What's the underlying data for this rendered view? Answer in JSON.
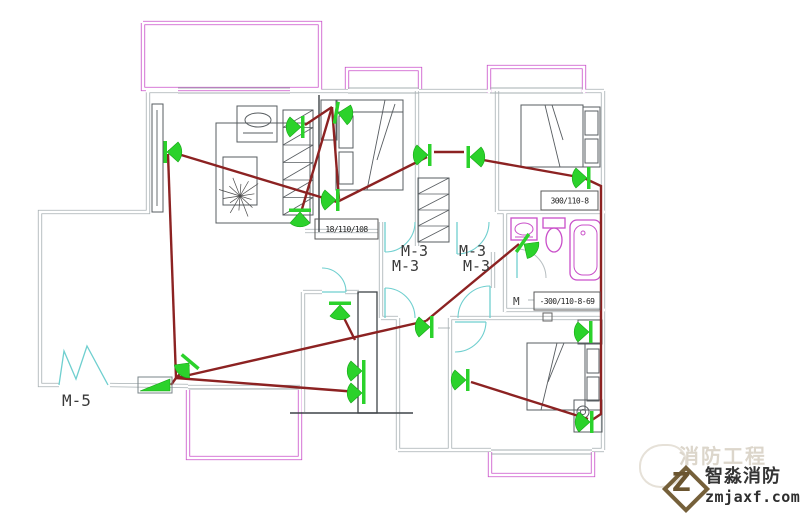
{
  "watermark": {
    "brand": "智淼消防",
    "site": "zmjaxf.com",
    "ghost": "消防工程",
    "logo_letter": "Z"
  },
  "drawing": {
    "canvas": {
      "w": 809,
      "h": 521
    },
    "colors": {
      "wall": "#a6afb2",
      "black": "#3f4448",
      "furn": "#575c60",
      "mag": "#c94fc9",
      "cyan": "#6fcfcf",
      "red": "#8c2222",
      "green": "#2bd22b",
      "greenEdge": "#17a817",
      "text": "#3a3a3a",
      "boxText": "#222222",
      "white": "#ffffff",
      "grayArc": "#b7bec1"
    },
    "walls_double": [
      [
        [
          148,
          92
        ],
        [
          148,
          212
        ],
        [
          40,
          212
        ],
        [
          40,
          385
        ],
        [
          59,
          385
        ]
      ],
      [
        [
          110,
          385
        ],
        [
          188,
          386
        ]
      ],
      [
        [
          146,
          91
        ],
        [
          178,
          91
        ]
      ],
      [
        [
          290,
          91
        ],
        [
          348,
          91
        ]
      ],
      [
        [
          419,
          91
        ],
        [
          491,
          91
        ]
      ],
      [
        [
          582,
          91
        ],
        [
          604,
          91
        ]
      ],
      [
        [
          603,
          91
        ],
        [
          603,
          450
        ]
      ],
      [
        [
          497,
          91
        ],
        [
          497,
          212
        ]
      ],
      [
        [
          417,
          91
        ],
        [
          417,
          246
        ]
      ],
      [
        [
          497,
          212
        ],
        [
          605,
          212
        ]
      ],
      [
        [
          505,
          212
        ],
        [
          505,
          312
        ]
      ],
      [
        [
          505,
          310
        ],
        [
          605,
          310
        ]
      ],
      [
        [
          305,
          231
        ],
        [
          378,
          231
        ]
      ],
      [
        [
          303,
          292
        ],
        [
          303,
          412
        ]
      ],
      [
        [
          303,
          292
        ],
        [
          322,
          292
        ]
      ],
      [
        [
          345,
          292
        ],
        [
          359,
          292
        ]
      ],
      [
        [
          188,
          387
        ],
        [
          300,
          387
        ]
      ],
      [
        [
          381,
          222
        ],
        [
          381,
          318
        ]
      ],
      [
        [
          493,
          252
        ],
        [
          493,
          288
        ]
      ],
      [
        [
          381,
          318
        ],
        [
          398,
          318
        ]
      ],
      [
        [
          398,
          318
        ],
        [
          398,
          450
        ]
      ],
      [
        [
          398,
          450
        ],
        [
          491,
          450
        ]
      ],
      [
        [
          592,
          450
        ],
        [
          604,
          450
        ]
      ],
      [
        [
          450,
          318
        ],
        [
          603,
          318
        ]
      ],
      [
        [
          450,
          318
        ],
        [
          450,
          450
        ]
      ]
    ],
    "walls_single": [
      [
        [
          178,
          88
        ],
        [
          290,
          88
        ]
      ],
      [
        [
          178,
          93
        ],
        [
          290,
          93
        ]
      ],
      [
        [
          348,
          88
        ],
        [
          419,
          88
        ]
      ],
      [
        [
          348,
          93
        ],
        [
          419,
          93
        ]
      ],
      [
        [
          490,
          88
        ],
        [
          583,
          88
        ]
      ],
      [
        [
          490,
          93
        ],
        [
          583,
          93
        ]
      ],
      [
        [
          491,
          450
        ],
        [
          592,
          450
        ]
      ],
      [
        [
          491,
          454
        ],
        [
          592,
          454
        ]
      ],
      [
        [
          189,
          389
        ],
        [
          299,
          389
        ]
      ],
      [
        [
          452,
          380
        ],
        [
          460,
          380
        ]
      ],
      [
        [
          438,
          328
        ],
        [
          450,
          328
        ]
      ],
      [
        [
          528,
          300
        ],
        [
          534,
          300
        ]
      ]
    ],
    "magenta_double": [
      [
        [
          143,
          23
        ],
        [
          320,
          23
        ],
        [
          320,
          89
        ],
        [
          143,
          89
        ],
        [
          143,
          23
        ]
      ],
      [
        [
          347,
          89
        ],
        [
          347,
          69
        ],
        [
          420,
          69
        ],
        [
          420,
          89
        ]
      ],
      [
        [
          489,
          93
        ],
        [
          489,
          67
        ],
        [
          584,
          67
        ],
        [
          584,
          93
        ]
      ],
      [
        [
          490,
          452
        ],
        [
          490,
          475
        ],
        [
          593,
          475
        ],
        [
          593,
          452
        ]
      ],
      [
        [
          188,
          390
        ],
        [
          188,
          458
        ],
        [
          300,
          458
        ],
        [
          300,
          390
        ]
      ]
    ],
    "black_lines": [
      [
        [
          319,
          95
        ],
        [
          319,
          232
        ]
      ],
      [
        [
          290,
          413
        ],
        [
          413,
          413
        ]
      ]
    ],
    "black_rects": [
      [
        358,
        292,
        19,
        121
      ]
    ],
    "furniture_rects": [
      [
        152,
        104,
        11,
        108
      ],
      [
        216,
        123,
        94,
        100
      ],
      [
        223,
        157,
        34,
        48
      ],
      [
        237,
        106,
        40,
        36
      ],
      [
        336,
        100,
        67,
        90
      ],
      [
        339,
        116,
        14,
        32
      ],
      [
        339,
        152,
        14,
        32
      ],
      [
        321,
        100,
        16,
        40
      ],
      [
        521,
        105,
        62,
        62
      ],
      [
        583,
        107,
        17,
        60
      ],
      [
        585,
        111,
        13,
        24
      ],
      [
        585,
        139,
        13,
        24
      ],
      [
        527,
        343,
        58,
        67
      ],
      [
        585,
        343,
        16,
        67
      ],
      [
        587,
        349,
        12,
        24
      ],
      [
        587,
        377,
        12,
        24
      ],
      [
        578,
        320,
        24,
        24
      ],
      [
        574,
        400,
        28,
        32
      ]
    ],
    "small_rects": [
      [
        543,
        313,
        9,
        8
      ]
    ],
    "furniture_lines": [
      [
        [
          157,
          110
        ],
        [
          157,
          206
        ]
      ],
      [
        [
          336,
          112
        ],
        [
          403,
          112
        ]
      ],
      [
        [
          385,
          100
        ],
        [
          367,
          190
        ]
      ],
      [
        [
          395,
          104
        ],
        [
          377,
          160
        ]
      ],
      [
        [
          545,
          105
        ],
        [
          560,
          167
        ]
      ],
      [
        [
          552,
          105
        ],
        [
          563,
          140
        ]
      ],
      [
        [
          557,
          343
        ],
        [
          541,
          410
        ]
      ],
      [
        [
          564,
          343
        ],
        [
          548,
          382
        ]
      ],
      [
        [
          243,
          133
        ],
        [
          273,
          133
        ]
      ]
    ],
    "furniture_circles": [
      [
        583,
        412,
        6
      ],
      [
        583,
        412,
        2.5
      ]
    ],
    "furniture_ellipses": [
      [
        258,
        120,
        13,
        7
      ]
    ],
    "plant": {
      "cx": 240,
      "cy": 196,
      "r": 22,
      "n": 14
    },
    "hatch_cabinets": [
      {
        "x": 283,
        "y": 110,
        "w": 30,
        "h": 105,
        "cells": 6
      },
      {
        "x": 418,
        "y": 178,
        "w": 31,
        "h": 64,
        "cells": 4
      }
    ],
    "cyan_lines": [
      [
        [
          385,
          222
        ],
        [
          385,
          252
        ]
      ],
      [
        [
          457,
          222
        ],
        [
          457,
          254
        ]
      ],
      [
        [
          385,
          288
        ],
        [
          385,
          318
        ]
      ],
      [
        [
          490,
          286
        ],
        [
          490,
          318
        ]
      ],
      [
        [
          517,
          249
        ],
        [
          517,
          278
        ]
      ],
      [
        [
          455,
          322
        ],
        [
          486,
          322
        ]
      ],
      [
        [
          322,
          292
        ],
        [
          346,
          292
        ]
      ],
      [
        [
          59,
          385
        ],
        [
          64,
          351
        ],
        [
          76,
          379
        ],
        [
          87,
          346
        ],
        [
          108,
          385
        ]
      ]
    ],
    "cyan_arcs": [
      "M385,252 A30,30 0 0 0 415,222",
      "M457,254 A32,32 0 0 0 489,222",
      "M385,288 A30,30 0 0 1 415,318",
      "M490,286 A32,32 0 0 0 458,318",
      "M486,322 A31,31 0 0 1 455,352",
      "M346,292 A24,24 0 0 0 322,268"
    ],
    "gray_arcs": [
      "M517,249 A29,29 0 0 1 546,278"
    ],
    "fixtures": {
      "sink_rect": [
        511,
        218,
        26,
        22
      ],
      "sink_ellipse": [
        524,
        229,
        9,
        6
      ],
      "sink_line": [
        [
          515,
          237
        ],
        [
          533,
          237
        ]
      ],
      "toilet_tank": [
        543,
        218,
        22,
        10
      ],
      "toilet_bowl": [
        554,
        240,
        8,
        12
      ],
      "tub_outer": [
        570,
        220,
        31,
        60,
        7
      ],
      "tub_inner": [
        574,
        225,
        23,
        50,
        9
      ],
      "tub_drain": [
        583,
        233,
        2
      ]
    },
    "wires": [
      [
        [
          168,
          151
        ],
        [
          337,
          202
        ]
      ],
      [
        [
          168,
          154
        ],
        [
          176,
          378
        ]
      ],
      [
        [
          176,
          378
        ],
        [
          189,
          365
        ]
      ],
      [
        [
          176,
          378
        ],
        [
          358,
          392
        ]
      ],
      [
        [
          176,
          378
        ],
        [
          426,
          321
        ]
      ],
      [
        [
          426,
          321
        ],
        [
          519,
          244
        ]
      ],
      [
        [
          337,
          202
        ],
        [
          427,
          157
        ]
      ],
      [
        [
          434,
          152
        ],
        [
          464,
          152
        ]
      ],
      [
        [
          472,
          158
        ],
        [
          584,
          178
        ]
      ],
      [
        [
          584,
          178
        ],
        [
          601,
          186
        ],
        [
          601,
          414
        ],
        [
          592,
          420
        ]
      ],
      [
        [
          471,
          382
        ],
        [
          588,
          419
        ]
      ],
      [
        [
          332,
          107
        ],
        [
          339,
          199
        ]
      ],
      [
        [
          332,
          107
        ],
        [
          302,
          209
        ]
      ],
      [
        [
          332,
          107
        ],
        [
          305,
          125
        ]
      ],
      [
        [
          341,
          312
        ],
        [
          355,
          340
        ]
      ],
      [
        [
          176,
          378
        ],
        [
          171,
          385
        ]
      ]
    ],
    "devices": [
      [
        167,
        152,
        0
      ],
      [
        301,
        127,
        180
      ],
      [
        338,
        113,
        10
      ],
      [
        336,
        200,
        180
      ],
      [
        300,
        212,
        90
      ],
      [
        428,
        155,
        180
      ],
      [
        470,
        157,
        0
      ],
      [
        524,
        244,
        35
      ],
      [
        587,
        178,
        180
      ],
      [
        589,
        332,
        180
      ],
      [
        362,
        371,
        180
      ],
      [
        362,
        393,
        180
      ],
      [
        430,
        327,
        180
      ],
      [
        466,
        380,
        180
      ],
      [
        590,
        422,
        180
      ],
      [
        189,
        363,
        130
      ],
      [
        340,
        305,
        90
      ]
    ],
    "module": {
      "box": [
        138,
        377,
        34,
        16
      ],
      "tri": [
        [
          140,
          391
        ],
        [
          170,
          391
        ],
        [
          170,
          379
        ]
      ]
    },
    "label_boxes": [
      {
        "x": 315,
        "y": 219,
        "w": 63,
        "h": 20,
        "t": "18/110/108"
      },
      {
        "x": 541,
        "y": 191,
        "w": 57,
        "h": 19,
        "t": "300/110-8"
      },
      {
        "x": 534,
        "y": 292,
        "w": 66,
        "h": 18,
        "t": "-300/110-8-69"
      }
    ],
    "text_labels": [
      {
        "x": 401,
        "y": 256,
        "t": "M-3",
        "s": 15
      },
      {
        "x": 392,
        "y": 271,
        "t": "M-3",
        "s": 15
      },
      {
        "x": 459,
        "y": 256,
        "t": "M-3",
        "s": 15
      },
      {
        "x": 463,
        "y": 271,
        "t": "M-3",
        "s": 15
      },
      {
        "x": 62,
        "y": 406,
        "t": "M-5",
        "s": 16
      },
      {
        "x": 513,
        "y": 305,
        "t": "M",
        "s": 11
      }
    ]
  }
}
